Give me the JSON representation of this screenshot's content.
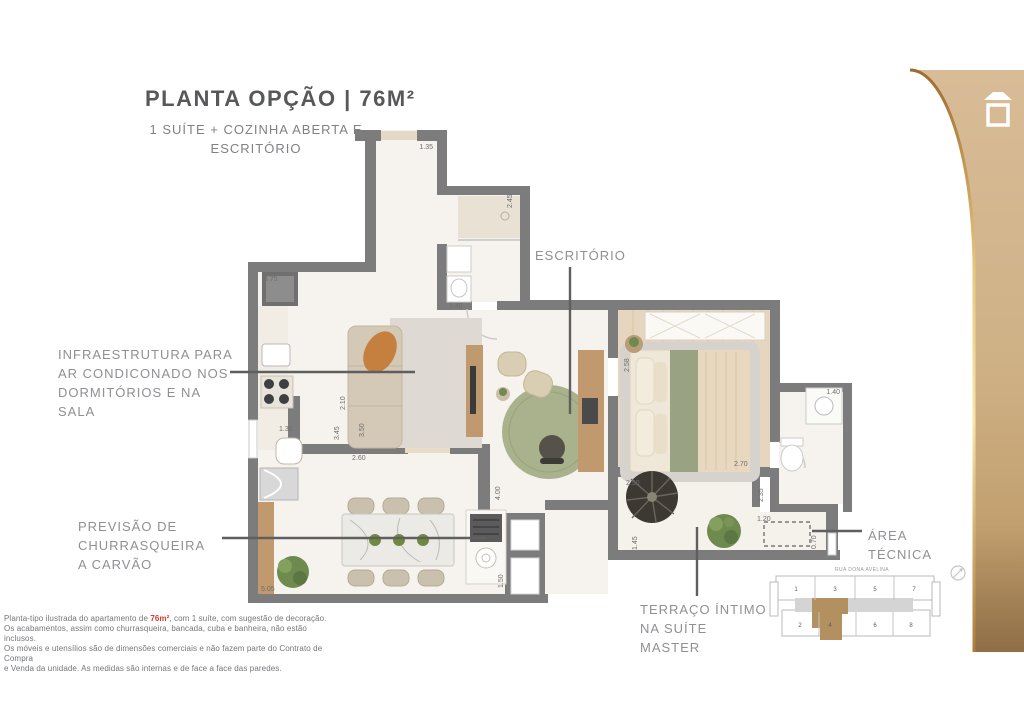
{
  "header": {
    "title": "PLANTA OPÇÃO | 76M²",
    "subtitle1": "1 SUÍTE + COZINHA ABERTA E",
    "subtitle2": "ESCRITÓRIO"
  },
  "labels": {
    "escritorio": "ESCRITÓRIO",
    "infra1": "INFRAESTRUTURA PARA",
    "infra2": "AR CONDICONADO NOS",
    "infra3": "DORMITÓRIOS E NA",
    "infra4": "SALA",
    "churras1": "PREVISÃO DE",
    "churras2": "CHURRASQUEIRA",
    "churras3": "A CARVÃO",
    "area1": "ÁREA",
    "area2": "TÉCNICA",
    "terraco1": "TERRAÇO ÍNTIMO",
    "terraco2": "NA SUÍTE",
    "terraco3": "MASTER"
  },
  "dims": {
    "entry": "1.35",
    "bath1_h": "2.45",
    "kitchen_counter": "3.75",
    "bath1_w": "1.40",
    "kitchen_w": "1.30",
    "living_a": "2.10",
    "living_b": "3.45",
    "living_c": "3.50",
    "living_w": "2.60",
    "office_h": "4.00",
    "bed_a": "2.58",
    "bed_w": "2.70",
    "bath2_w": "1.40",
    "terr_a": "2.50",
    "terr_b": "2.35",
    "terr_c": "1.20",
    "terr_d": "0.70",
    "terr_e": "1.45",
    "dining_w": "5.05",
    "churras_h": "1.50"
  },
  "disclaimer": {
    "l1_pre": "Planta-tipo ilustrada do apartamento de ",
    "l1_hl": "76m²",
    "l1_post": ", com 1 suíte, com sugestão de decoração.",
    "l2": "Os acabamentos, assim como churrasqueira, bancada, cuba e banheira, não estão inclusos.",
    "l3": "Os móveis e utensílios são de dimensões comerciais e não fazem parte do Contrato de Compra",
    "l4": "e Venda da unidade. As medidas são internas e de face a face das paredes."
  },
  "keyplan": {
    "street": "RUA DONA AVELINA",
    "units": [
      "1",
      "3",
      "5",
      "7",
      "2",
      "4",
      "6",
      "8"
    ],
    "highlighted_unit": "4"
  },
  "colors": {
    "wall": "#7c7c7c",
    "wood": "#c09a6e",
    "panel_tan": "#d2b48e",
    "accent_red": "#cf3a32",
    "keyplan_highlight": "#b3905f"
  }
}
